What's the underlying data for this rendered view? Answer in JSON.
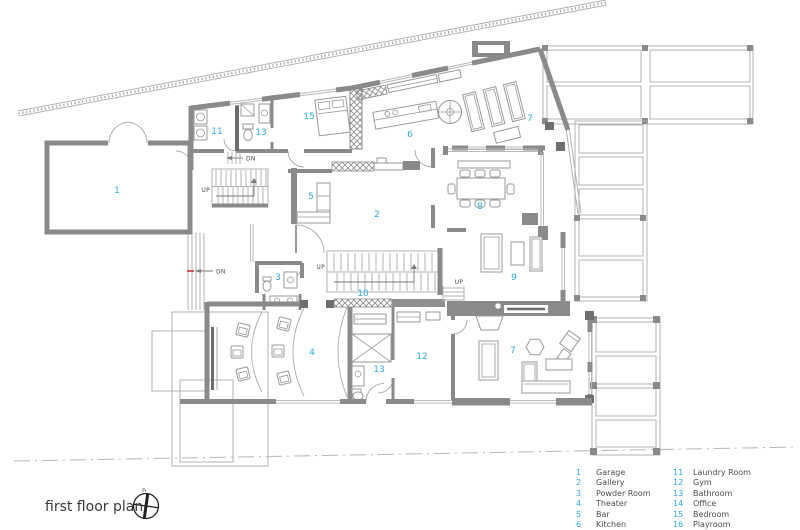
{
  "title": "first floor plan",
  "compass": {
    "north": "n"
  },
  "colors": {
    "room_number": "#29abe2",
    "wall": "#8a8a8a",
    "accent_red": "#c8342b",
    "legend_text": "#4d4d4d"
  },
  "plan_labels": {
    "garage": "1",
    "laundry": "11",
    "bathroom_top": "13",
    "bedroom": "15",
    "kitchen": "6",
    "lounge_top": "7",
    "bar": "5",
    "gallery": "2",
    "dining": "8",
    "living": "9",
    "powder": "3",
    "hall": "10",
    "theater": "4",
    "bathroom_bottom": "13",
    "gym": "12",
    "family": "7"
  },
  "annotations": {
    "dn_top": "DN",
    "up_garage": "UP",
    "dn_west": "DN",
    "up_main": "UP",
    "up_deck": "UP"
  },
  "legend": {
    "columns": [
      {
        "entries": [
          {
            "num": "1",
            "name": "Garage"
          },
          {
            "num": "2",
            "name": "Gallery"
          },
          {
            "num": "3",
            "name": "Powder Room"
          },
          {
            "num": "4",
            "name": "Theater"
          },
          {
            "num": "5",
            "name": "Bar"
          },
          {
            "num": "6",
            "name": "Kitchen"
          }
        ]
      },
      {
        "entries": [
          {
            "num": "11",
            "name": "Laundry Room"
          },
          {
            "num": "12",
            "name": "Gym"
          },
          {
            "num": "13",
            "name": "Bathroom"
          },
          {
            "num": "14",
            "name": "Office"
          },
          {
            "num": "15",
            "name": "Bedroom"
          },
          {
            "num": "16",
            "name": "Playroom"
          }
        ]
      }
    ]
  }
}
